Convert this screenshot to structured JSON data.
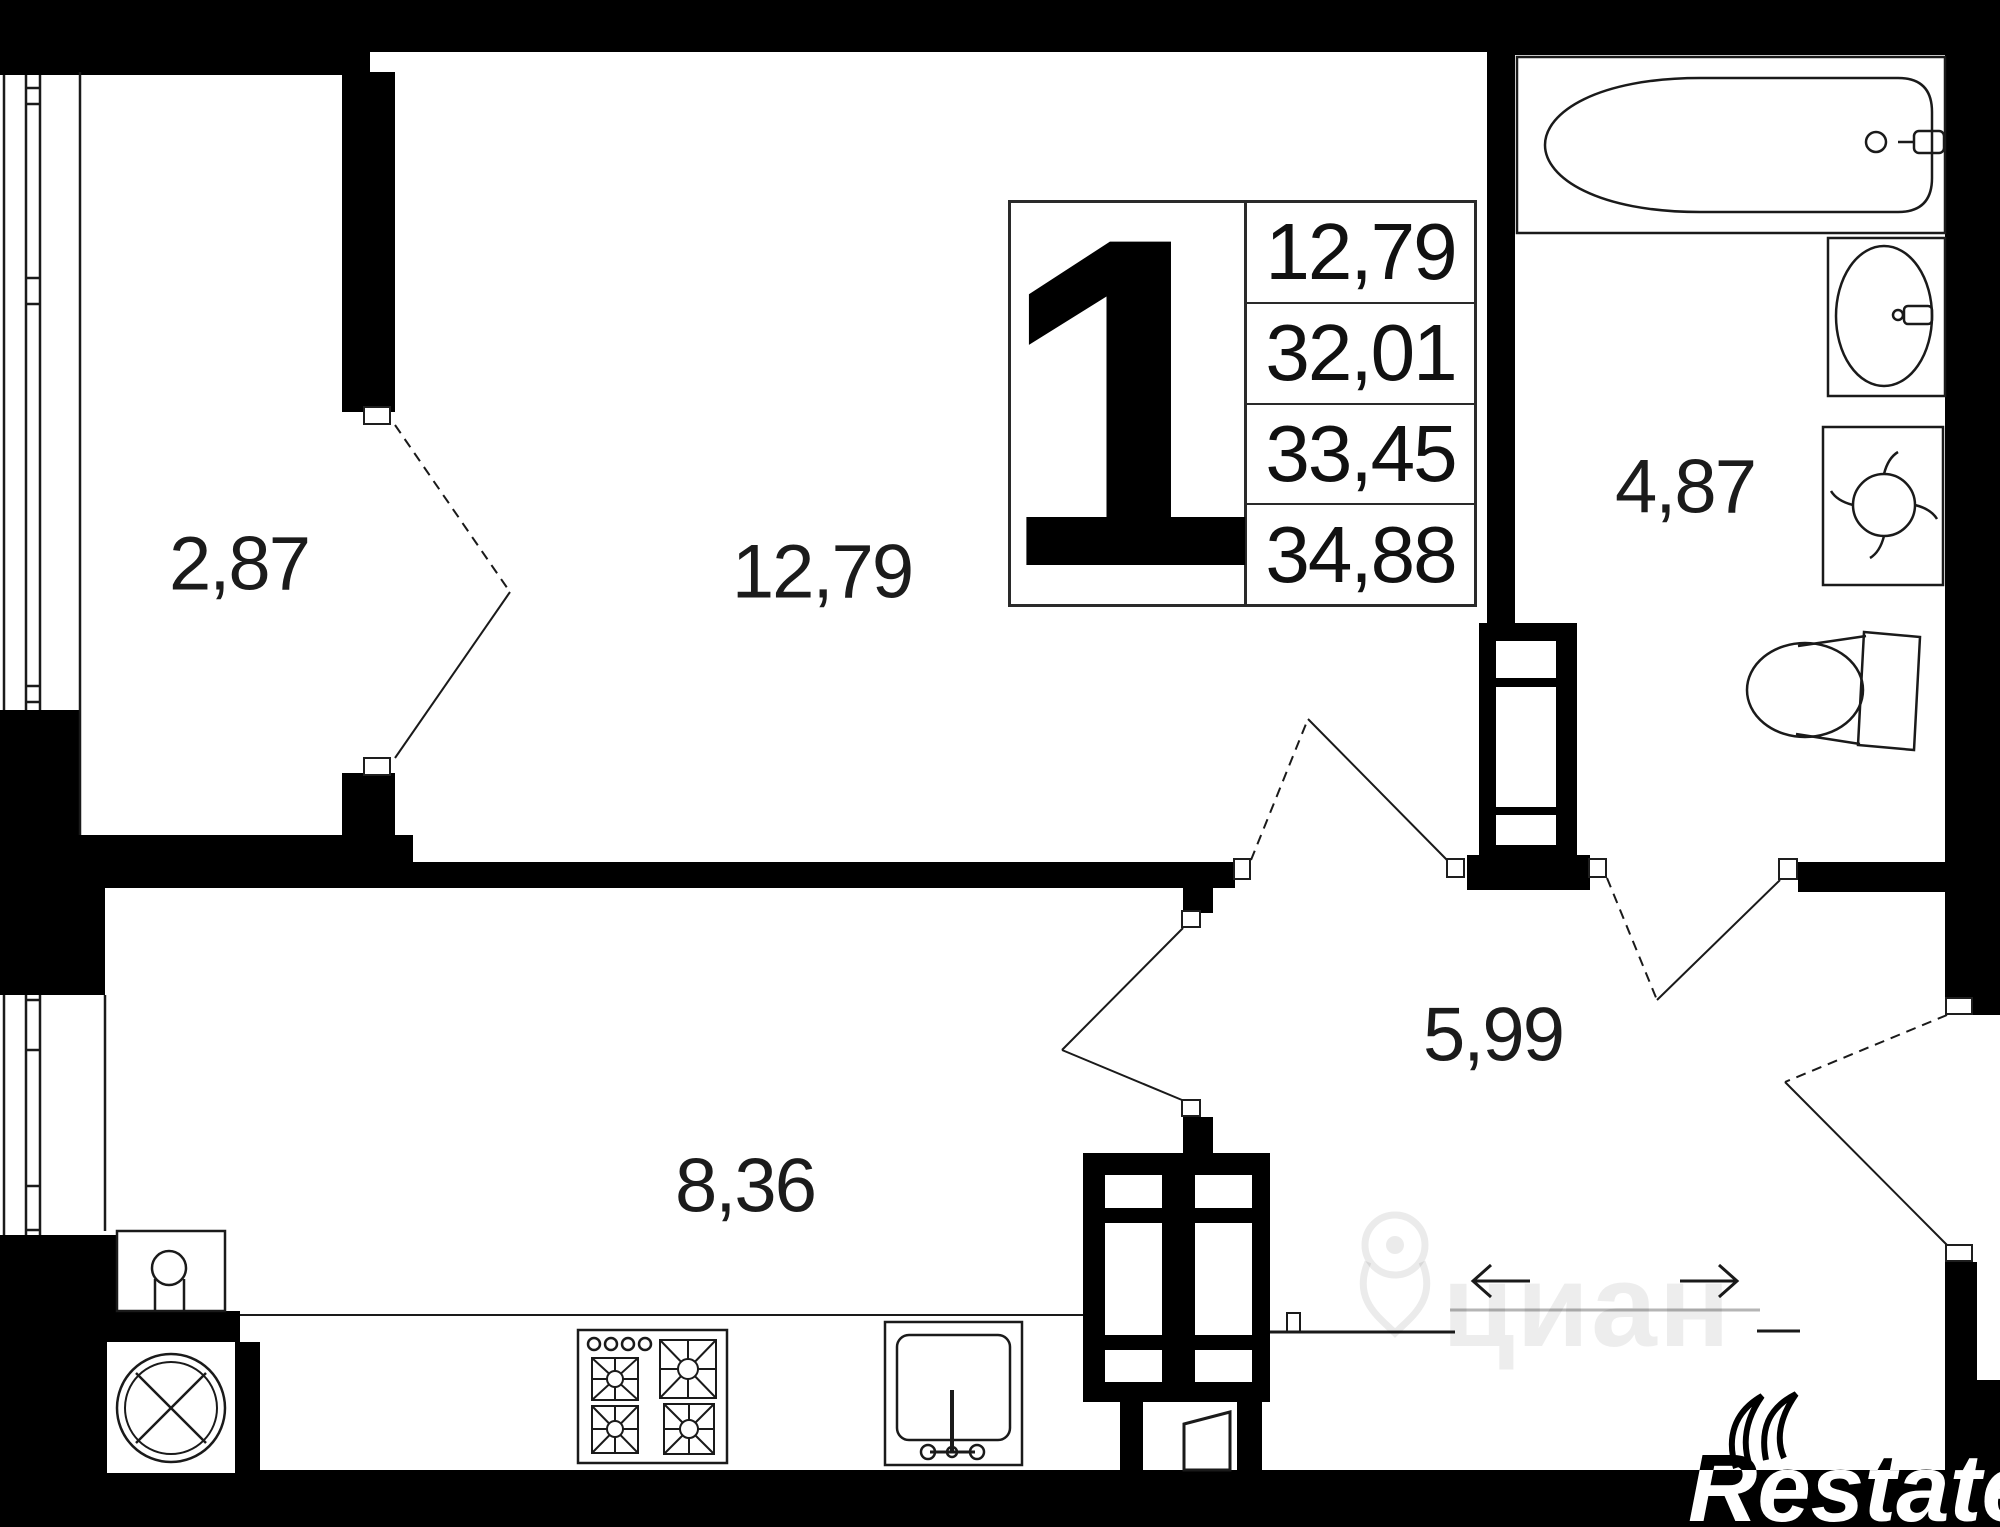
{
  "unit_card": {
    "number": "1",
    "values": [
      "12,79",
      "32,01",
      "33,45",
      "34,88"
    ]
  },
  "rooms": {
    "loggia": {
      "area": "2,87"
    },
    "living": {
      "area": "12,79"
    },
    "bathroom": {
      "area": "4,87"
    },
    "hallway": {
      "area": "5,99"
    },
    "kitchen": {
      "area": "8,36"
    }
  },
  "watermarks": {
    "brand": "Restate",
    "portal": "циан"
  },
  "colors": {
    "wall": "#000000",
    "line": "#1a1a1a",
    "label": "#1b1b1b",
    "watermark_gray": "rgba(0,0,0,0.07)"
  },
  "fixtures": [
    "bathtub",
    "bathroom-sink",
    "washing-machine",
    "toilet",
    "stove",
    "kitchen-sink",
    "radiator",
    "ventilation-duct",
    "entry-arrows"
  ]
}
